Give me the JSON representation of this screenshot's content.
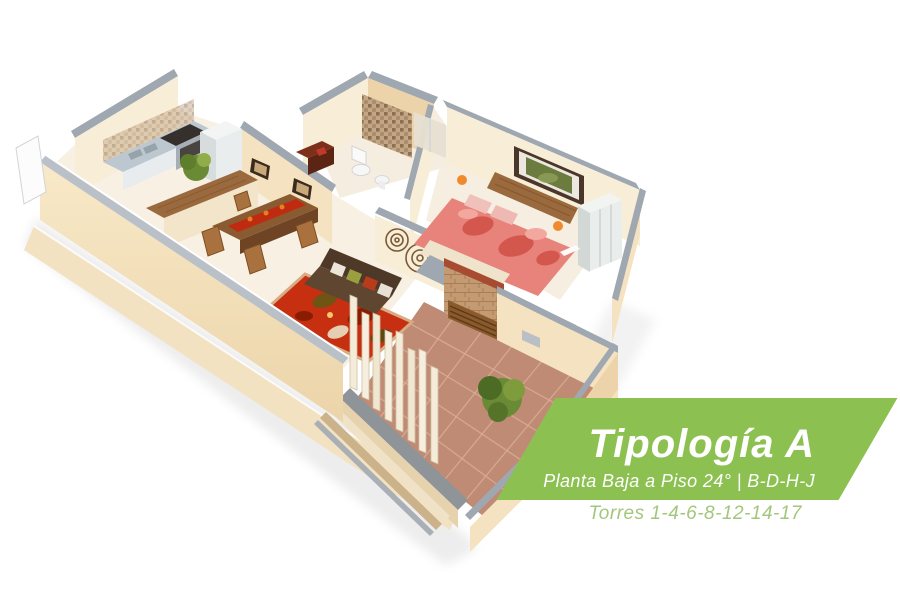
{
  "banner": {
    "title": "Tipología A",
    "subtitle": "Planta Baja a Piso 24° | B-D-H-J",
    "towers_line": "Torres 1-4-6-8-12-14-17"
  },
  "floorplan": {
    "style": "3D isometric cutaway apartment render",
    "depicts": [
      "kitchen",
      "dining-area",
      "living-room",
      "hallway",
      "bathroom",
      "bedroom",
      "terrace"
    ]
  },
  "palette": {
    "banner_green": "#8CC152",
    "towers_green": "#A3C77A",
    "wall_top_gray": "#9FA7B0",
    "wall_cream_light": "#F8EDD6",
    "wall_cream": "#F4E2C0",
    "wall_cream_dark": "#ECD3A9",
    "floor_light": "#F7F0E3",
    "terrace_tile": "#C08B74",
    "terrace_grout": "#D8AD96",
    "parapet_gray": "#8F9499",
    "rug_red": "#C5290A",
    "runner_red": "#C02A10",
    "steel_gray": "#BCC7CF",
    "wood_mid": "#9A6A3E",
    "wood_dark": "#8A5A30",
    "sofa_brown": "#4E3828",
    "bed_pink": "#E8837C",
    "plant_green": "#6B8A36",
    "brick_red": "#A84C31",
    "brick_tan": "#C49A72",
    "art_green": "#6B7C3E",
    "lamp_orange": "#F08A2E"
  }
}
